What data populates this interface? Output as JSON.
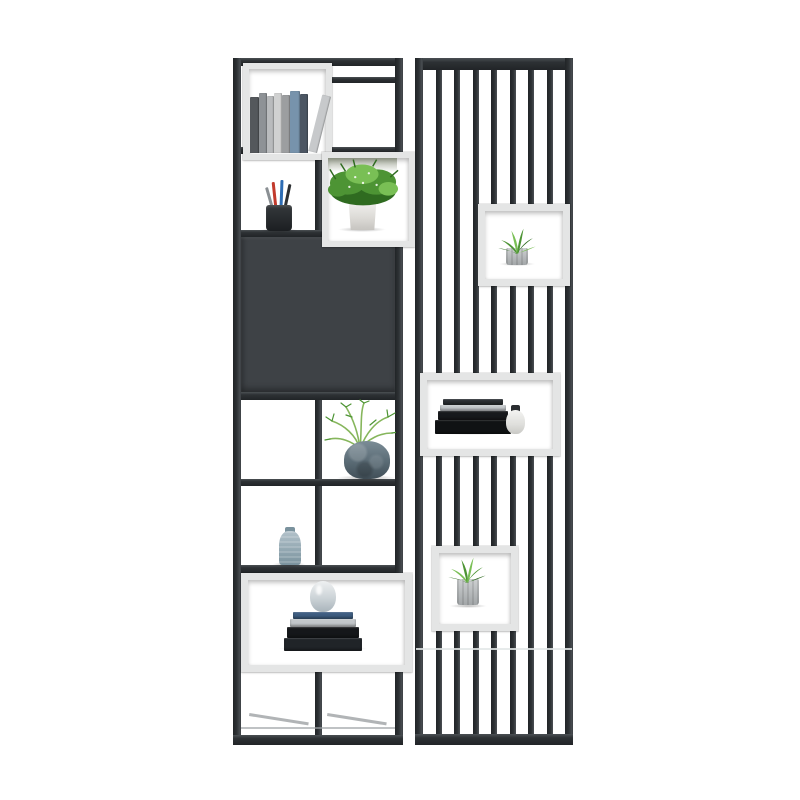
{
  "product": {
    "title": "Black metal display bookshelf with slatted screen room divider, styled with plants, books and vases",
    "background": "#ffffff"
  },
  "colors": {
    "frame": "#2d3134",
    "frame_dark": "#212427",
    "frame_light": "#4b5054",
    "cabinet": "#3e4246",
    "box_frame": "#e4e5e5",
    "foliage_dark": "#2f6b20",
    "foliage": "#4d9434",
    "foliage_light": "#79bf55",
    "sprig": "#86b65c",
    "pot_blue": "#7b8c96",
    "pot_blue_dark": "#414f58",
    "pot_gray": "#cdd0d1",
    "pot_gray_dark": "#a2a6a8",
    "jar_blue": "#b3c2ca",
    "jar_blue_dark": "#7a929d",
    "vase_gray": "#a9b4bb",
    "vase_cap": "#2a2d30",
    "pen_red": "#c23a2c",
    "pen_blue": "#2e6db4",
    "pen_dark": "#2d3033",
    "pen_gray": "#8a8f93",
    "depth_line": "#9da1a4"
  },
  "left_unit": {
    "inventory": [
      "row of standing books in white box",
      "empty cell with top rail",
      "black pencil cup with pens",
      "leafy plant in white pot inside white box",
      "closed dark cabinet panel",
      "feathery plant in blue-gray stone pot",
      "small blue ceramic jar",
      "white box with stacked books and teardrop vase",
      "empty lower grid cells"
    ],
    "book_spines": [
      {
        "color": "#54585c",
        "w": 9,
        "h": 56
      },
      {
        "color": "#8e9296",
        "w": 8,
        "h": 60
      },
      {
        "color": "#b9bbbd",
        "w": 7,
        "h": 57
      },
      {
        "color": "#d0d1d1",
        "w": 8,
        "h": 60
      },
      {
        "color": "#9c9ea0",
        "w": 8,
        "h": 58
      },
      {
        "color": "#7793ac",
        "w": 10,
        "h": 62
      },
      {
        "color": "#4c5663",
        "w": 8,
        "h": 59
      },
      {
        "color": "#c7c9cb",
        "w": 9,
        "h": 58,
        "lean": 14
      }
    ],
    "floor_stack": [
      {
        "color": "#202428",
        "w": 78,
        "h": 13
      },
      {
        "color": "#15171a",
        "w": 72,
        "h": 11
      },
      {
        "color": "#c3c7ca",
        "w": 66,
        "h": 8
      },
      {
        "color": "#3e5d80",
        "w": 60,
        "h": 7
      }
    ]
  },
  "screen": {
    "slat_count": 7,
    "boxes": [
      {
        "content": "succulent in gray ribbed pot"
      },
      {
        "content": "stack of dark books with small capped vase"
      },
      {
        "content": "succulent in gray ribbed pot"
      }
    ],
    "box_stack": [
      {
        "color": "#101214",
        "w": 76,
        "h": 14
      },
      {
        "color": "#17191c",
        "w": 70,
        "h": 9
      },
      {
        "color": "#c6cacd",
        "w": 66,
        "h": 6
      },
      {
        "color": "#2b2f33",
        "w": 60,
        "h": 6
      }
    ]
  }
}
